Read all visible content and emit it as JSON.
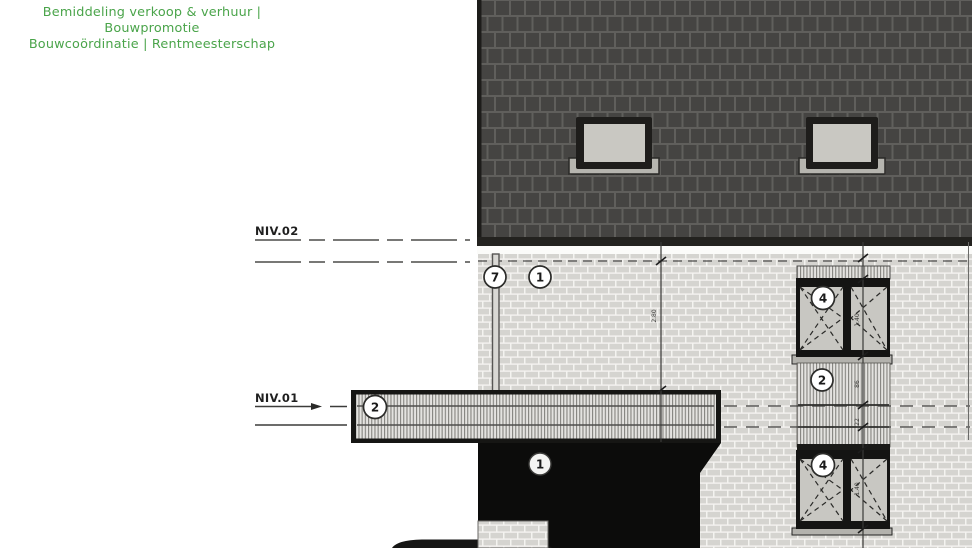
{
  "header": {
    "line1": "Bemiddeling verkoop & verhuur | Bouwpromotie",
    "line2": "Bouwcoördinatie | Rentmeesterschap"
  },
  "levels": {
    "upper_label": "NIV.02",
    "lower_label": "NIV.01"
  },
  "bubbles": [
    {
      "id": "bubble-7-downpipe",
      "label": "7"
    },
    {
      "id": "bubble-1-facade-upper",
      "label": "1"
    },
    {
      "id": "bubble-4-window-upper",
      "label": "4"
    },
    {
      "id": "bubble-2-spandrel-panel",
      "label": "2"
    },
    {
      "id": "bubble-2-canopy",
      "label": "2"
    },
    {
      "id": "bubble-1-entrance",
      "label": "1"
    },
    {
      "id": "bubble-4-window-lower",
      "label": "4"
    }
  ],
  "dimensions": [
    {
      "value": "2.80"
    },
    {
      "value": "1.40"
    },
    {
      "value": "86"
    },
    {
      "value": "22"
    },
    {
      "value": "1.40"
    }
  ],
  "colors": {
    "brand_green": "#4aa44a",
    "roof_tile": "#454442",
    "brick": "#d5d4d0",
    "frame_black": "#141413",
    "entrance_shadow": "#0c0c0b"
  }
}
